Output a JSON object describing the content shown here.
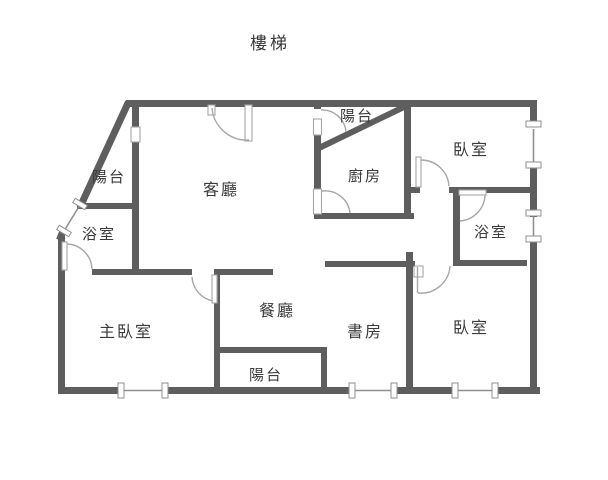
{
  "colors": {
    "wall": "#5e5e5e",
    "door_arc": "#a6a6a6",
    "window": "#8f8f8f",
    "label_text": "#3a3a3a",
    "background": "#ffffff"
  },
  "floorplan": {
    "stairs_label": "樓梯",
    "rooms": [
      {
        "id": "balcony-top-left",
        "label": "陽台"
      },
      {
        "id": "bathroom-left",
        "label": "浴室"
      },
      {
        "id": "living-room",
        "label": "客廳"
      },
      {
        "id": "balcony-kitchen",
        "label": "陽台"
      },
      {
        "id": "kitchen",
        "label": "廚房"
      },
      {
        "id": "bedroom-top-right",
        "label": "臥室"
      },
      {
        "id": "bathroom-right",
        "label": "浴室"
      },
      {
        "id": "master-bedroom",
        "label": "主臥室"
      },
      {
        "id": "dining-room",
        "label": "餐廳"
      },
      {
        "id": "balcony-bottom",
        "label": "陽台"
      },
      {
        "id": "study",
        "label": "書房"
      },
      {
        "id": "bedroom-bottom-right",
        "label": "臥室"
      }
    ]
  }
}
